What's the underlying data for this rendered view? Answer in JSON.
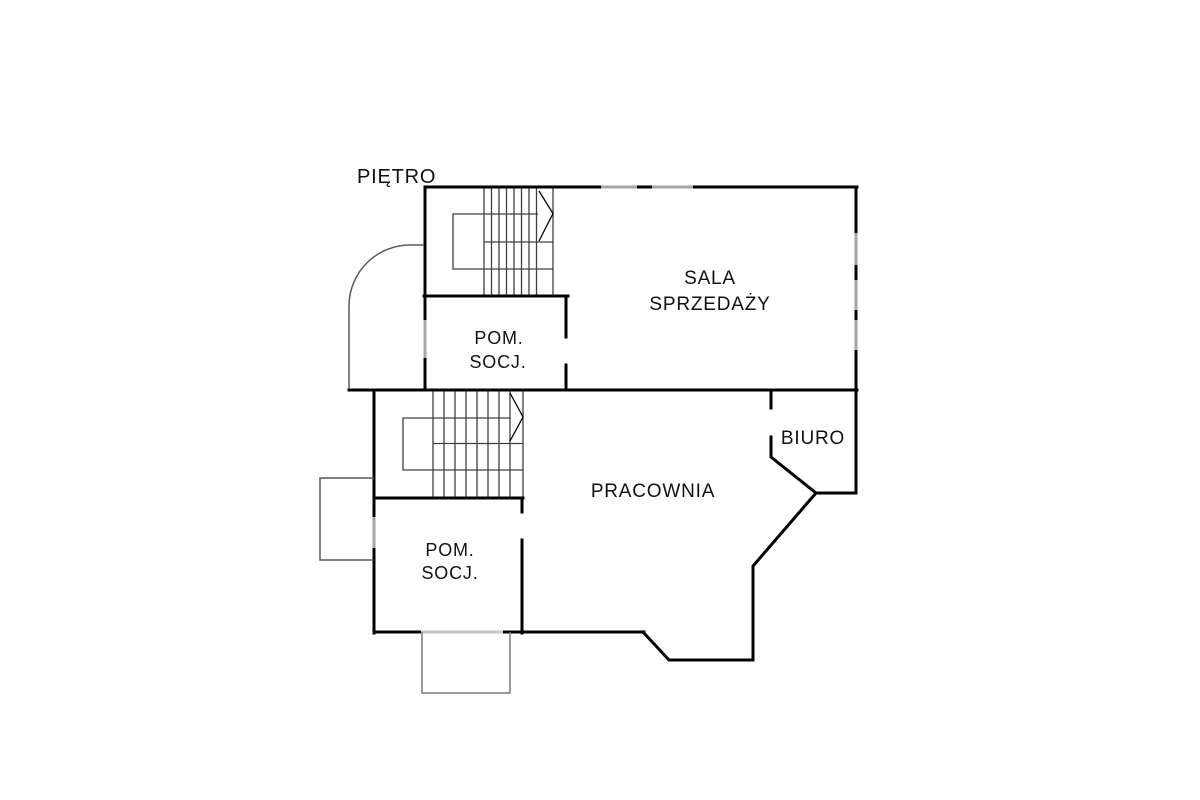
{
  "title": "PIĘTRO",
  "rooms": {
    "sala_sprzedazy": {
      "line1": "SALA",
      "line2": "SPRZEDAŻY"
    },
    "pom_socj_gorne": {
      "line1": "POM.",
      "line2": "SOCJ."
    },
    "biuro": {
      "label": "BIURO"
    },
    "pracownia": {
      "label": "PRACOWNIA"
    },
    "pom_socj_dolne": {
      "line1": "POM.",
      "line2": "SOCJ."
    }
  },
  "colors": {
    "background": "#ffffff",
    "wall": "#000000",
    "opening": "#a6a6a6",
    "opening_light": "#c4c4c4",
    "stair_line": "#404040",
    "annex_line": "#595959",
    "annex_light": "#7a7a7a",
    "arrow": "#000000",
    "text": "#111111"
  }
}
